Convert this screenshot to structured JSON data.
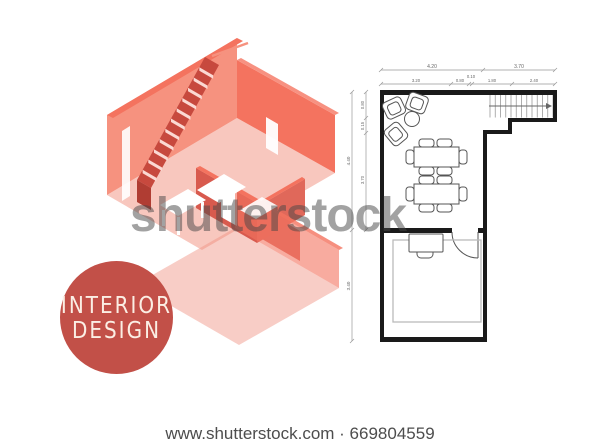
{
  "watermark": {
    "text": "shutterstock",
    "color": "rgba(70,70,70,0.5)"
  },
  "caption": {
    "text": "www.shutterstock.com · 669804559",
    "color": "#4d4d4d"
  },
  "badge": {
    "line1": "INTERIOR",
    "line2": "DESIGN",
    "bg_color": "#c25048",
    "text_color": "#fbeee4"
  },
  "illustration": {
    "description": "isometric cutaway apartment with staircase",
    "palette": {
      "coral": "#f4735f",
      "coral_light": "#f6927f",
      "floor_pink": "#f8c7be",
      "dark_red": "#d85a4e",
      "stair_riser": "#c7493e",
      "stair_tread": "#fbd9d3"
    }
  },
  "floor_plan": {
    "wall_color": "#1a1a1a",
    "dimensions": {
      "top_row1": [
        "4.20",
        "3.70"
      ],
      "top_row2": [
        "3.20",
        "0.80",
        "0.10",
        "1.80",
        "2.40"
      ],
      "left_outer": [
        "4.40",
        "3.40"
      ],
      "left_inner": [
        "0.80",
        "0.15",
        "3.70"
      ]
    },
    "elements": [
      "lounge-armchairs",
      "coffee-table",
      "dining-table-6-chairs",
      "dining-table-6-chairs",
      "staircase-up-arrow",
      "door-swing",
      "desk-with-chair",
      "area-rug"
    ]
  }
}
